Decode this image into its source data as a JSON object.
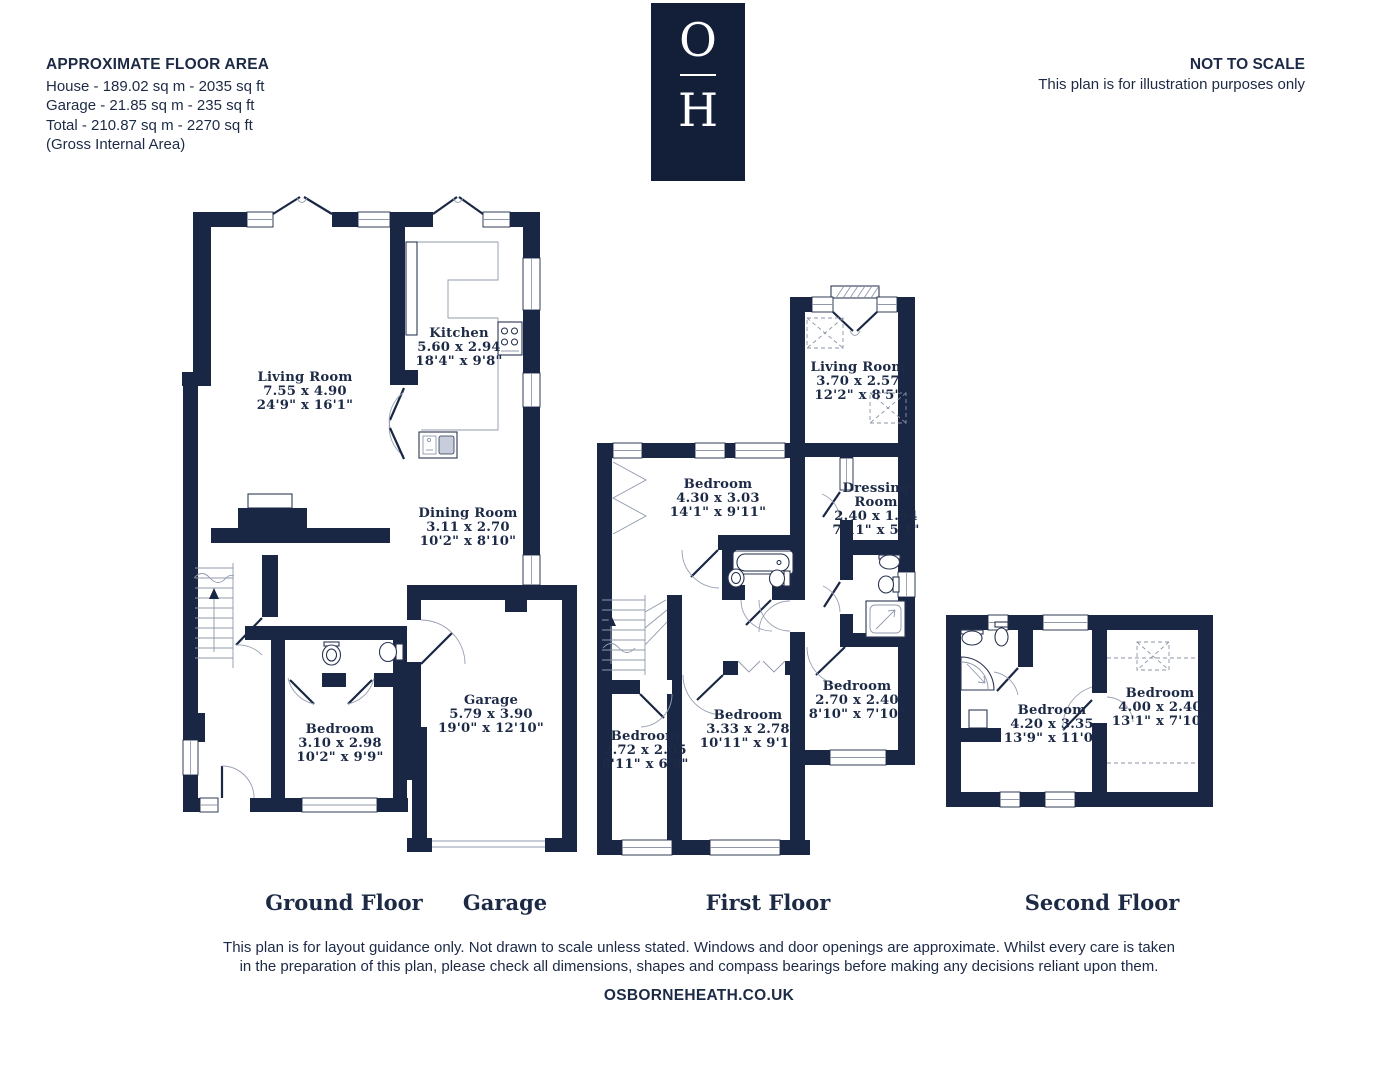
{
  "header": {
    "floor_area_title": "APPROXIMATE FLOOR AREA",
    "floor_area_lines": [
      "House - 189.02 sq m - 2035 sq ft",
      "Garage - 21.85 sq m - 235 sq ft",
      "Total - 210.87 sq m - 2270 sq ft",
      "(Gross Internal Area)"
    ],
    "logo_top": "O",
    "logo_bottom": "H",
    "not_to_scale": "NOT TO SCALE",
    "illustration_note": "This plan is for illustration purposes only"
  },
  "colors": {
    "wall": "#1a2744",
    "ink": "#1d2a46",
    "logo_bg": "#131f38",
    "background": "#ffffff"
  },
  "floors": {
    "ground": {
      "label": "Ground Floor"
    },
    "garage": {
      "label": "Garage"
    },
    "first": {
      "label": "First Floor"
    },
    "second": {
      "label": "Second Floor"
    }
  },
  "rooms": {
    "ground_living": {
      "name": "Living Room",
      "metric": "7.55 x 4.90",
      "imperial": "24'9\" x 16'1\""
    },
    "kitchen": {
      "name": "Kitchen",
      "metric": "5.60 x 2.94",
      "imperial": "18'4\" x 9'8\""
    },
    "dining": {
      "name": "Dining Room",
      "metric": "3.11 x 2.70",
      "imperial": "10'2\" x 8'10\""
    },
    "ground_bedroom": {
      "name": "Bedroom",
      "metric": "3.10 x 2.98",
      "imperial": "10'2\" x 9'9\""
    },
    "garage": {
      "name": "Garage",
      "metric": "5.79 x 3.90",
      "imperial": "19'0\" x 12'10\""
    },
    "first_living": {
      "name": "Living Room",
      "metric": "3.70 x 2.57",
      "imperial": "12'2\" x 8'5\""
    },
    "first_bedroom_1": {
      "name": "Bedroom",
      "metric": "4.30 x 3.03",
      "imperial": "14'1\" x 9'11\""
    },
    "dressing": {
      "name_line1": "Dressing",
      "name_line2": "Room",
      "metric": "2.40 x 1.54",
      "imperial": "7'11\" x 5'1\""
    },
    "first_bedroom_2": {
      "name": "Bedroom",
      "metric": "2.70 x 2.40",
      "imperial": "8'10\" x 7'10\""
    },
    "first_bedroom_3": {
      "name": "Bedroom",
      "metric": "3.33 x 2.78",
      "imperial": "10'11\" x 9'1\""
    },
    "first_bedroom_4": {
      "name": "Bedroom",
      "metric": "2.72 x 2.05",
      "imperial": "8'11\" x 6'9\""
    },
    "second_bedroom_1": {
      "name": "Bedroom",
      "metric": "4.20 x 3.35",
      "imperial": "13'9\" x 11'0\""
    },
    "second_bedroom_2": {
      "name": "Bedroom",
      "metric": "4.00 x 2.40",
      "imperial": "13'1\" x 7'10\""
    }
  },
  "footer": {
    "disclaimer_line1": "This plan is for layout guidance only. Not drawn to scale unless stated. Windows and door openings are approximate. Whilst every care is taken",
    "disclaimer_line2": "in the preparation of this plan, please check all dimensions, shapes and compass bearings before making any decisions reliant upon them.",
    "website": "OSBORNEHEATH.CO.UK"
  }
}
